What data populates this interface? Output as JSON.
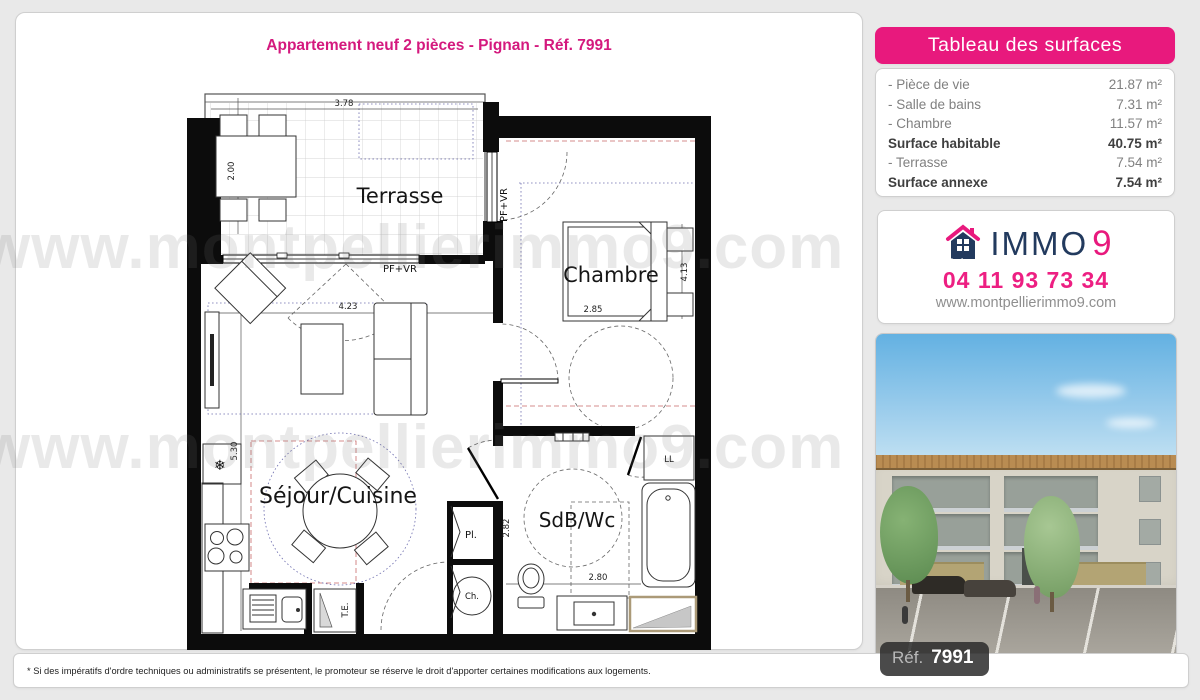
{
  "title": "Appartement neuf 2 pièces - Pignan - Réf. 7991",
  "watermark": {
    "text": "www.montpellierimmo9.com"
  },
  "colors": {
    "accent_pink": "#e8197d",
    "brand_navy": "#223a5e"
  },
  "floor_plan": {
    "room_labels": {
      "terrasse": "Terrasse",
      "chambre": "Chambre",
      "sejour_cuisine": "Séjour/Cuisine",
      "sdb_wc": "SdB/Wc"
    },
    "fixture_labels": {
      "pf_vr_bay": "PF+VR",
      "pf_vr_window": "PF+VR",
      "te": "T.E.",
      "pl": "Pl.",
      "ch": "Ch.",
      "ll": "LL"
    },
    "icons": {
      "snowflake": "❄"
    },
    "dimensions": {
      "terrasse_width": "3.78",
      "terrasse_depth": "2.00",
      "sejour_width": "4.23",
      "sejour_depth": "5.30",
      "chambre_width": "2.85",
      "chambre_depth": "4.13",
      "sdb_depth": "2.82",
      "sdb_width": "2.80"
    }
  },
  "surface_table": {
    "header": "Tableau des surfaces",
    "rows": [
      {
        "label": "- Pièce de vie",
        "value": "21.87 m²",
        "bold": false
      },
      {
        "label": "- Salle de bains",
        "value": "7.31 m²",
        "bold": false
      },
      {
        "label": "- Chambre",
        "value": "11.57 m²",
        "bold": false
      },
      {
        "label": "Surface habitable",
        "value": "40.75 m²",
        "bold": true
      },
      {
        "label": "- Terrasse",
        "value": "7.54 m²",
        "bold": false
      },
      {
        "label": "Surface annexe",
        "value": "7.54 m²",
        "bold": true
      }
    ]
  },
  "agency": {
    "brand_immo": "IMMO",
    "brand_nine": "9",
    "phone": "04 11 93 73 34",
    "website": "www.montpellierimmo9.com"
  },
  "photo": {
    "ref_label": "Réf.",
    "ref_value": "7991"
  },
  "disclaimer": "* Si des impératifs d'ordre techniques ou administratifs se présentent, le promoteur se réserve le droit d'apporter certaines modifications aux logements."
}
